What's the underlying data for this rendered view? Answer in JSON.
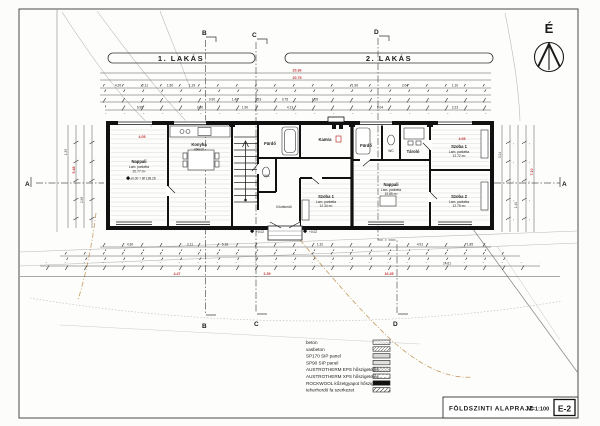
{
  "sheet": {
    "title_block": {
      "title": "FÖLDSZINTI ALAPRAJZ",
      "scale": "M=1:100",
      "sheet_no": "E-2"
    },
    "colors": {
      "ink": "#1a1a1a",
      "red": "#c13333",
      "terrain": "#b9b9b5",
      "boundary_orange": "#c59a5d"
    }
  },
  "compass": {
    "label": "É"
  },
  "apartment_bars": {
    "left": "1. LAKÁS",
    "right": "2. LAKÁS"
  },
  "section_markers": {
    "top_b": "B",
    "top_c": "C",
    "top_d": "D",
    "bottom_b": "B",
    "bottom_c": "C",
    "bottom_d": "D",
    "side_left": "A",
    "side_right": "A"
  },
  "rooms": {
    "nappali1": {
      "name": "Nappali",
      "floor": "Lam. parketta",
      "area": "20.77 m²"
    },
    "konyha": {
      "name": "Konyha",
      "sub": "étkező"
    },
    "furdo1": {
      "name": "Fürdő"
    },
    "wc1": {
      "name": "WC"
    },
    "kamra": {
      "name": "Kamra"
    },
    "kozlekedo1": {
      "name": "Közlekedő"
    },
    "szoba1a": {
      "name": "Szoba 1",
      "floor": "Lam. parketta",
      "area": "12.34 m²"
    },
    "furdo2": {
      "name": "Fürdő"
    },
    "wc2": {
      "name": "WC"
    },
    "tarolo": {
      "name": "Tároló"
    },
    "nappali2": {
      "name": "Nappali",
      "floor": "Lam. parketta",
      "area": "19.85 m²"
    },
    "szoba1b": {
      "name": "Szoba 1",
      "floor": "Lam. parketta",
      "area": "12.72 m²"
    },
    "szoba2b": {
      "name": "Szoba 2",
      "floor": "Lam. parketta",
      "area": "12.75 m²"
    }
  },
  "levels": {
    "ground": "±0.00 = Bf 138.26",
    "entry_left": "+0.02",
    "entry_right": "+0.02"
  },
  "dims": {
    "top_total_red": [
      "20.36",
      "20.75"
    ],
    "apt1_red": "4.05",
    "apt2_red": "4.05",
    "top_small": [
      "4.20",
      "2.11",
      "1.50",
      "1.19",
      "0.90",
      "1.40",
      "2.23",
      "0.75",
      "1.05",
      "1.90",
      "2.04",
      "1.10"
    ],
    "top_mid": [
      "6.95",
      "0.90",
      "1.90",
      "4.13",
      "8.04",
      "2.23"
    ],
    "bottom_small": [
      "4.30",
      "2.11",
      "5.18",
      "1.32",
      "4.91",
      "1.85"
    ],
    "bottom_red": [
      "4.47",
      "2.39",
      "16.45"
    ],
    "bottom_black": "14.61",
    "left_vert": [
      "1.35",
      "2.98"
    ],
    "left_vert_red": "5.48",
    "right_vert": [
      "3.24",
      "1.40"
    ],
    "right_vert_red": "7.10"
  },
  "legend": {
    "items": [
      {
        "label": "beton"
      },
      {
        "label": "vasbeton"
      },
      {
        "label": "SP170 SIP panel"
      },
      {
        "label": "SP90 SIP panel"
      },
      {
        "label": "AUSTROTHERM EPS hőszigetelés"
      },
      {
        "label": "AUSTROTHERM XPS hőszigetelés"
      },
      {
        "label": "ROCKWOOL kőzetgyapot hőszigetelés"
      },
      {
        "label": "teherhordó fa szerkezet"
      }
    ]
  }
}
